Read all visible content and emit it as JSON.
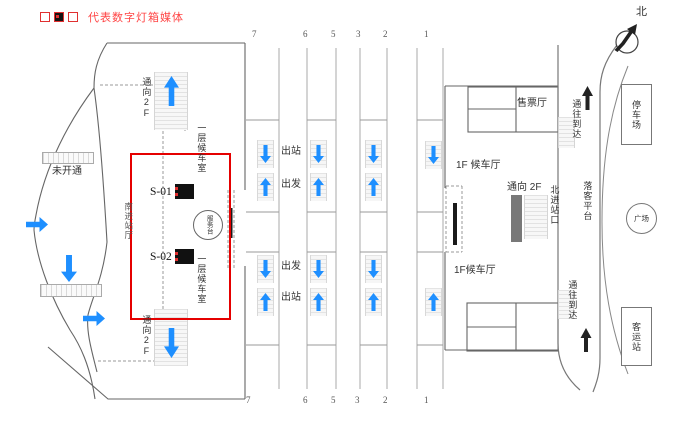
{
  "colors": {
    "highlight_red": "#e50000",
    "arrow_blue": "#1e8fff",
    "legend_red": "#ff4545"
  },
  "legend": {
    "icon": "lightbox-media-icon",
    "label": "代表数字灯箱媒体"
  },
  "compass": {
    "label": "北",
    "icon": "compass-needle-icon"
  },
  "left_building": {
    "not_open": "未开通",
    "to_2f_upper": "通向2F",
    "to_2f_lower": "通向2F",
    "waiting_room_upper": "一层候车室",
    "waiting_room_lower": "一层候车室",
    "south_entrance_hall": "南进站厅",
    "service_desk": "服务台",
    "media": [
      {
        "label": "S-01"
      },
      {
        "label": "S-02"
      }
    ]
  },
  "platforms": {
    "numbers_top": [
      "7",
      "6",
      "5",
      "3",
      "2",
      "1"
    ],
    "numbers_bottom": [
      "7",
      "6",
      "5",
      "3",
      "2",
      "1"
    ],
    "exit_upper": "出站",
    "depart_upper": "出发",
    "depart_lower": "出发",
    "exit_lower": "出站"
  },
  "right_building": {
    "ticket_hall": "售票厅",
    "waiting_hall_upper": "1F 候车厅",
    "waiting_hall_lower": "1F候车厅",
    "to_2f": "通向 2F",
    "north_entrance": "北进站口",
    "to_arrival_upper": "通往到达",
    "to_arrival_lower": "通往到达",
    "drop_off_platform": "落客平台"
  },
  "plaza": {
    "parking": "停车场",
    "square": "广场",
    "bus_station": "客运站"
  }
}
